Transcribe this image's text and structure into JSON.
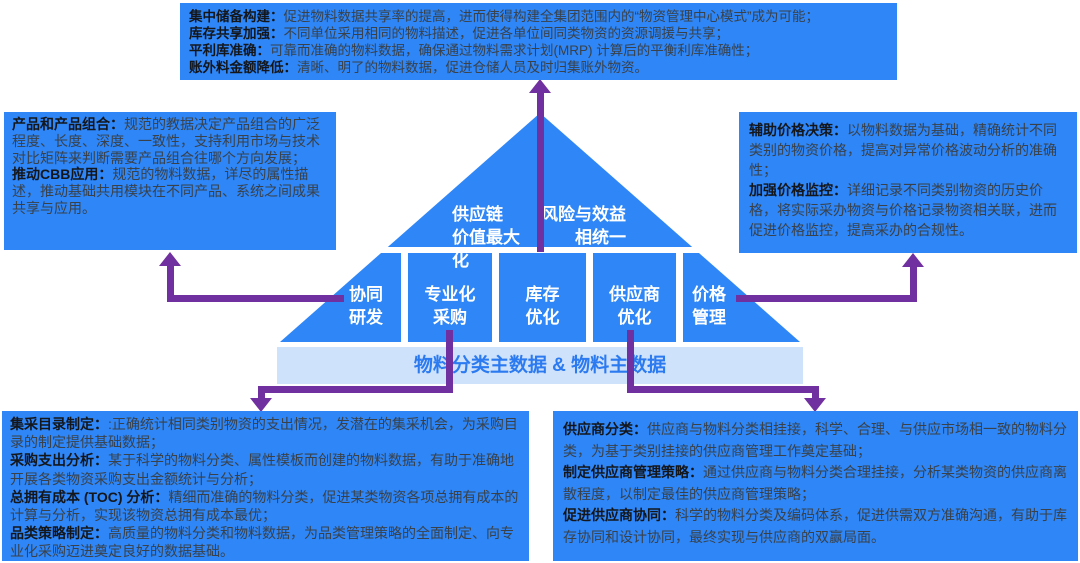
{
  "colors": {
    "primary_blue": "#2e86f7",
    "base_bar_bg": "#cfe2fb",
    "base_bar_text": "#2b7af0",
    "connector_purple": "#7030a0",
    "head_text": "#14161a",
    "body_text": "#3a4149",
    "pyramid_label_text": "#ffffff"
  },
  "top_box": {
    "paragraphs": [
      {
        "head": "集中储备构建：",
        "body": "促进物料数据共享率的提高，进而使得构建全集团范围内的“物资管理中心模式”成为可能；"
      },
      {
        "head": "库存共享加强：",
        "body": "不同单位采用相同的物料描述，促进各单位间同类物资的资源调援与共享；"
      },
      {
        "head": "平利库准确：",
        "body": "可靠而准确的物料数据，确保通过物料需求计划(MRP) 计算后的平衡利库准确性；"
      },
      {
        "head": "账外料金额降低：",
        "body": "清晰、明了的物料数据，促进仓储人员及时归集账外物资。"
      }
    ]
  },
  "left_box": {
    "paragraphs": [
      {
        "head": "产品和产品组合：",
        "body": "规范的教据决定产品组合的广泛程度、长度、深度、一致性，支持利用市场与技术对比矩阵来判断需要产品组合往哪个方向发展；"
      },
      {
        "head": "推动CBB应用：",
        "body": "规范的物料数据，详尽的属性描述，推动基础共用模块在不同产品、系统之间成果共享与应用。"
      }
    ]
  },
  "right_box": {
    "paragraphs": [
      {
        "head": "辅助价格决策：",
        "body": "以物料数据为基础，精确统计不同类别的物资价格，提高对异常价格波动分析的准确性；"
      },
      {
        "head": "加强价格监控：",
        "body": "详细记录不同类别物资的历史价格，将实际采办物资与价格记录物资相关联，进而促进价格监控，提高采办的合规性。"
      }
    ]
  },
  "bottom_left_box": {
    "paragraphs": [
      {
        "head": "集采目录制定：",
        "body": ":正确统计相同类别物资的支出情况，发潜在的集采机会，为采购目录的制定提供基础数据；"
      },
      {
        "head": "采购支出分析：",
        "body": "某于科学的物料分类、属性模板而创建的物料数据，有助于准确地开展各类物资采购支出金额统计与分析；"
      },
      {
        "head": "总拥有成本 (TOC) 分析：",
        "body": "精细而准确的物料分类，促进某类物资各项总拥有成本的计算与分析，实现该物资总拥有成本最优；"
      },
      {
        "head": "品类策略制定：",
        "body": "高质量的物料分类和物料数据，为品类管理策略的全面制定、向专业化采购迈进奠定良好的数据基础。"
      }
    ]
  },
  "bottom_right_box": {
    "paragraphs": [
      {
        "head": "供应商分类：",
        "body": "供应商与物料分类相挂接，科学、合理、与供应市场相一致的物料分类，为基于类别挂接的供应商管理工作奠定基础；"
      },
      {
        "head": "制定供应商管理策略：",
        "body": "通过供应商与物料分类合理挂接，分析某类物资的供应商离散程度，以制定最佳的供应商管理策略；"
      },
      {
        "head": "促进供应商协同：",
        "body": "科学的物料分类及编码体系，促进供需双方准确沟通，有助于库存协同和设计协同，最终实现与供应商的双赢局面。"
      }
    ]
  },
  "pyramid": {
    "goal_left": "供应链\n价值最大化",
    "goal_right": "风险与效益\n相统一",
    "cells": [
      {
        "label": "协同\n研发"
      },
      {
        "label": "专业化\n采购"
      },
      {
        "label": "库存\n优化"
      },
      {
        "label": "供应商\n优化"
      },
      {
        "label": "价格\n管理"
      }
    ],
    "base_label": "物料分类主数据 & 物料主数据"
  }
}
